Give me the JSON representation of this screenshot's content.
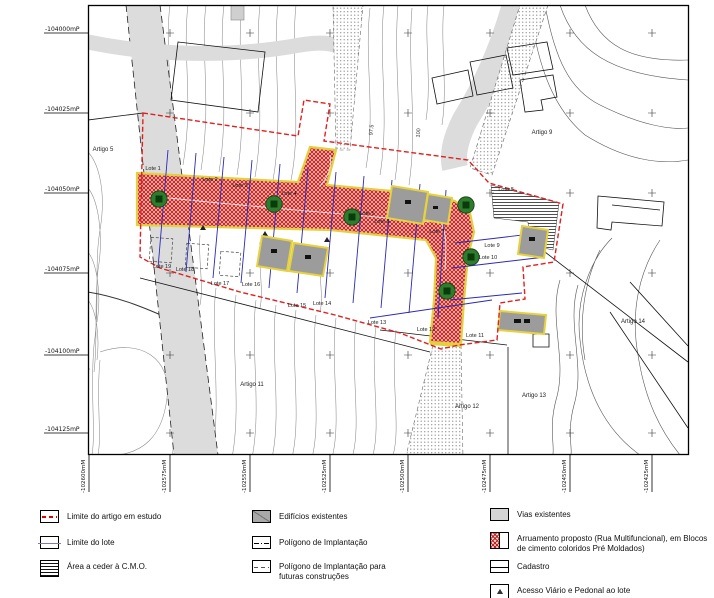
{
  "map": {
    "y_axis": [
      "-104000mP",
      "-104025mP",
      "-104050mP",
      "-104075mP",
      "-104100mP",
      "-104125mP"
    ],
    "x_axis": [
      "-102600mM",
      "-102575mM",
      "-102550mM",
      "-102525mM",
      "-102500mM",
      "-102475mM",
      "-102450mM",
      "-102425mM"
    ],
    "labels": {
      "artigo_5": "Artigo 5",
      "artigo_9": "Artigo 9",
      "artigo_11": "Artigo 11",
      "artigo_12": "Artigo 12",
      "artigo_13": "Artigo 13",
      "artigo_14": "Artigo 14",
      "lote_1": "Lote 1",
      "lote_2": "Lote 2",
      "lote_3": "Lote 3",
      "lote_4": "Lote 4",
      "lote_5": "Lote 5",
      "lote_6": "Lote 6",
      "lote_7": "Lote 7",
      "lote_8": "Lote 8",
      "lote_9": "Lote 9",
      "lote_10": "Lote 10",
      "lote_11": "Lote 11",
      "lote_12": "Lote 12",
      "lote_13": "Lote 13",
      "lote_14": "Lote 14",
      "lote_15": "Lote 15",
      "lote_16": "Lote 16",
      "lote_17": "Lote 17",
      "lote_18": "Lote 18",
      "lote_19": "Lote 19",
      "contour_97_5": "97.5",
      "contour_100": "100",
      "contour_87_5": "87.5"
    }
  },
  "legend": {
    "items": [
      {
        "label": "Limite do artigo em estudo"
      },
      {
        "label": "Limite do lote"
      },
      {
        "label": "Área a ceder à C.M.O."
      },
      {
        "label": "Edifícios existentes"
      },
      {
        "label": "Polígono de Implantação"
      },
      {
        "label": "Polígono de Implantação para",
        "label2": "futuras construções"
      },
      {
        "label": "Vias existentes"
      },
      {
        "label": "Arruamento proposto (Rua Multifuncional), em Blocos",
        "label2": "de cimento coloridos Pré Moldados)"
      },
      {
        "label": "Cadastro"
      },
      {
        "label": "Acesso Viário e Pedonal ao lote"
      }
    ]
  },
  "colors": {
    "proposed_street_red": "#c42020",
    "street_edge_yellow": "#e3cf3f",
    "tree_green": "#2e7d2e",
    "lot_line_blue": "#2929b8",
    "study_limit_red": "#e02020",
    "existing_road_gray": "#dcdcdc",
    "building_gray": "#9c9c9c"
  }
}
